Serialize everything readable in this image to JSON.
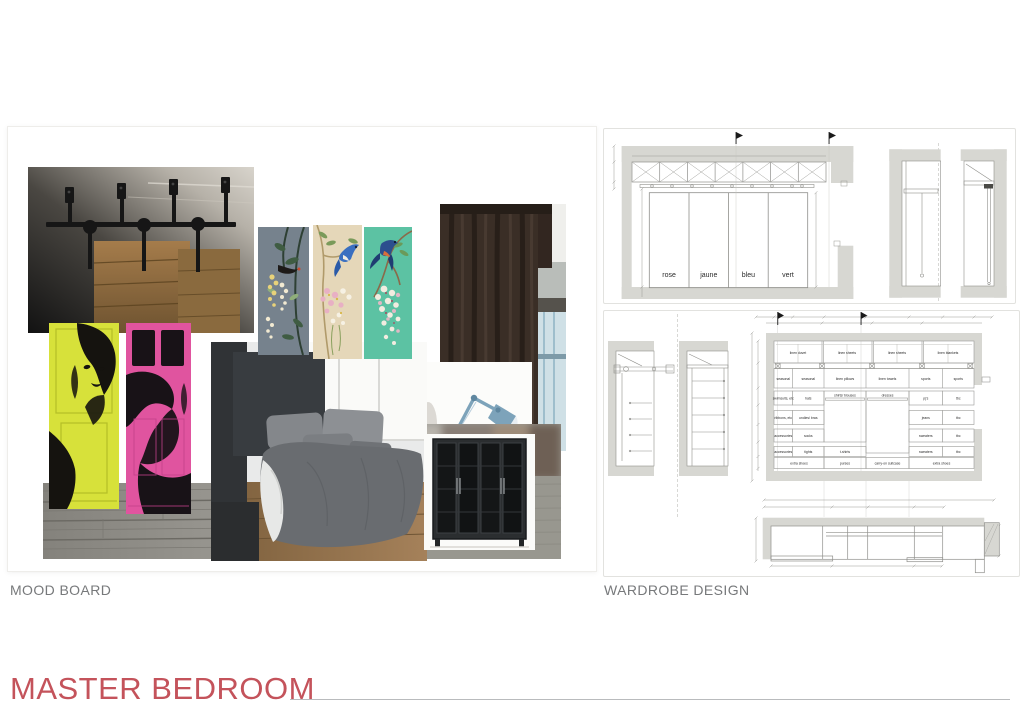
{
  "page": {
    "title": "MASTER BEDROOM"
  },
  "sections": {
    "mood_board": {
      "label": "MOOD BOARD"
    },
    "wardrobe": {
      "label": "WARDROBE DESIGN"
    }
  },
  "colors": {
    "accent_red": "#c4535b",
    "section_label_gray": "#77797b",
    "drawing_wall_gray": "#d7d7d2",
    "door_yellow": "#d7e13a",
    "door_pink": "#e0549f",
    "panel_teal": "#5cc2a3",
    "panel_cream": "#e5d7b9",
    "panel_slate": "#76828d",
    "curtain_brown": "#3a2e26",
    "lamp_blue": "#7da3ba"
  },
  "wardrobe": {
    "door_labels": [
      "rose",
      "jaune",
      "bleu",
      "vert"
    ],
    "compartments": {
      "upper_row": [
        "linen duvet",
        "linen sheets",
        "linen sheets",
        "linen blankets"
      ],
      "shelf_row": [
        "seasonal",
        "seasonal",
        "linen pillows",
        "linen towels",
        "sports",
        "sports"
      ],
      "left_col1": [
        "swimsuits, etc",
        "ribbons, etc",
        "accessories",
        "accessories"
      ],
      "left_col2": [
        "hats",
        "undies/ bras",
        "socks",
        "tights"
      ],
      "center_tall": [
        "shirts/ blouses",
        "dresses"
      ],
      "center_small": [
        "t-shirts"
      ],
      "right_col1": [
        "pj's",
        "jeans",
        "sweaters",
        "sweaters"
      ],
      "right_col2": [
        "tbc",
        "tbc",
        "tbc",
        "tbc"
      ],
      "bottom_row": [
        "extra shoes",
        "purses",
        "carry-on suitcase",
        "extra shoes"
      ]
    }
  }
}
